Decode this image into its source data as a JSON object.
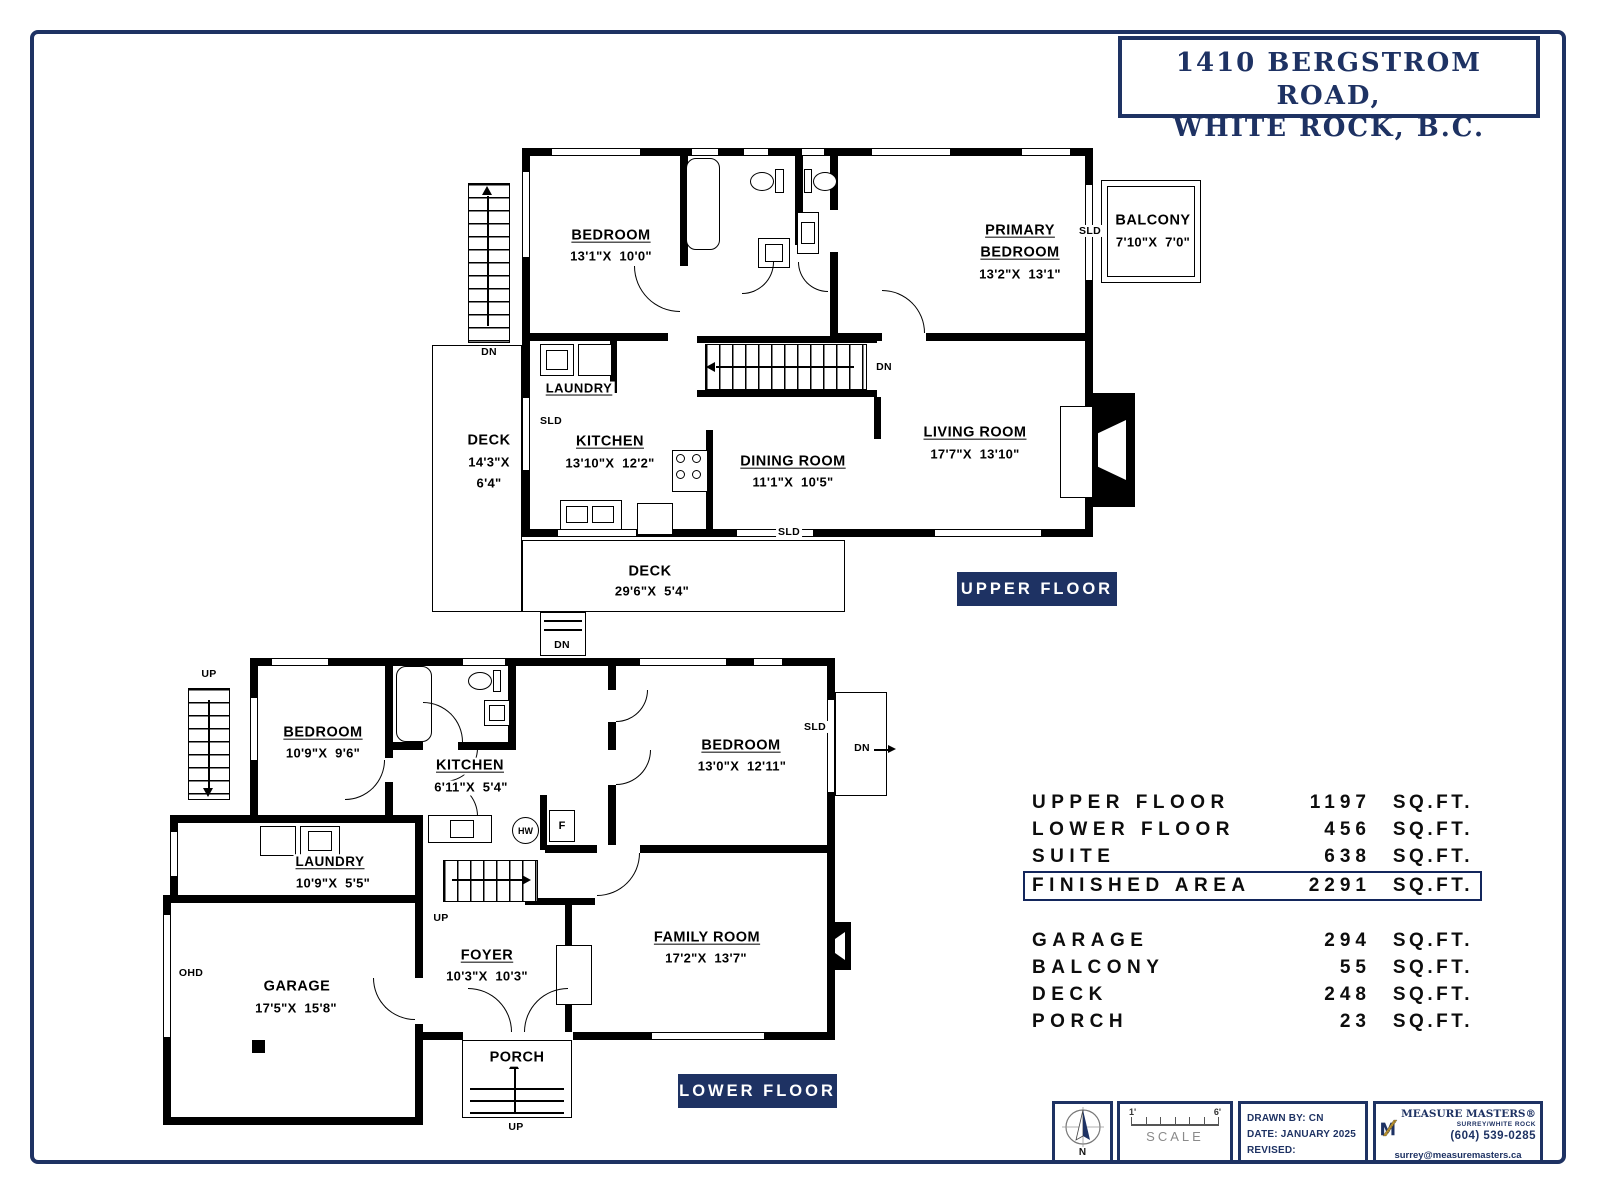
{
  "title": {
    "line1": "1410 BERGSTROM ROAD,",
    "line2": "WHITE ROCK, B.C."
  },
  "colors": {
    "navy": "#1e3263",
    "plan_black": "#000000",
    "logo_gold": "#b8902e"
  },
  "upper": {
    "tag": "UPPER FLOOR",
    "bedroom": {
      "name": "BEDROOM",
      "dims": "13'1\"X  10'0\""
    },
    "primary": {
      "name1": "PRIMARY",
      "name2": "BEDROOM",
      "dims": "13'2\"X  13'1\""
    },
    "balcony": {
      "name": "BALCONY",
      "dims": "7'10\"X  7'0\"",
      "sld": "SLD"
    },
    "laundry": {
      "name": "LAUNDRY"
    },
    "deck_side": {
      "name": "DECK",
      "dim1": "14'3\"X",
      "dim2": "6'4\""
    },
    "kitchen": {
      "name": "KITCHEN",
      "dims": "13'10\"X  12'2\"",
      "sld": "SLD"
    },
    "dining": {
      "name": "DINING ROOM",
      "dims": "11'1\"X  10'5\"",
      "sld": "SLD"
    },
    "living": {
      "name": "LIVING ROOM",
      "dims": "17'7\"X  13'10\""
    },
    "deck_bottom": {
      "name": "DECK",
      "dims": "29'6\"X  5'4\""
    },
    "stairs_dn": "DN",
    "ext_stairs_dn": "DN",
    "deck_stairs_dn": "DN"
  },
  "lower": {
    "tag": "LOWER FLOOR",
    "ext_stairs_up": "UP",
    "bedroom1": {
      "name": "BEDROOM",
      "dims": "10'9\"X  9'6\""
    },
    "kitchen": {
      "name": "KITCHEN",
      "dims": "6'11\"X  5'4\""
    },
    "bedroom2": {
      "name": "BEDROOM",
      "dims": "13'0\"X  12'11\"",
      "sld": "SLD",
      "dn": "DN"
    },
    "laundry": {
      "name": "LAUNDRY",
      "dims": "10'9\"X  5'5\""
    },
    "hot_water": "HW",
    "furnace": "F",
    "ohd": "OHD",
    "garage": {
      "name": "GARAGE",
      "dims": "17'5\"X  15'8\""
    },
    "stairs_up": "UP",
    "foyer": {
      "name": "FOYER",
      "dims": "10'3\"X  10'3\""
    },
    "family": {
      "name": "FAMILY ROOM",
      "dims": "17'2\"X  13'7\""
    },
    "porch": {
      "name": "PORCH",
      "up": "UP"
    }
  },
  "area_table": {
    "rows": [
      {
        "label": "UPPER FLOOR",
        "value": "1197",
        "unit": "SQ.FT."
      },
      {
        "label": "LOWER FLOOR",
        "value": "456",
        "unit": "SQ.FT."
      },
      {
        "label": "SUITE",
        "value": "638",
        "unit": "SQ.FT."
      },
      {
        "label": "FINISHED AREA",
        "value": "2291",
        "unit": "SQ.FT."
      },
      {
        "label": "GARAGE",
        "value": "294",
        "unit": "SQ.FT."
      },
      {
        "label": "BALCONY",
        "value": "55",
        "unit": "SQ.FT."
      },
      {
        "label": "DECK",
        "value": "248",
        "unit": "SQ.FT."
      },
      {
        "label": "PORCH",
        "value": "23",
        "unit": "SQ.FT."
      }
    ]
  },
  "footer": {
    "north": "N",
    "scale": {
      "start": "1'",
      "end": "6'",
      "label": "SCALE"
    },
    "drawn_by": "DRAWN BY: CN",
    "date": "DATE: JANUARY 2025",
    "revised": "REVISED:",
    "company": {
      "name": "MEASURE MASTERS®",
      "sub": "SURREY/WHITE ROCK",
      "phone": "(604) 539-0285",
      "email": "surrey@measuremasters.ca"
    }
  }
}
